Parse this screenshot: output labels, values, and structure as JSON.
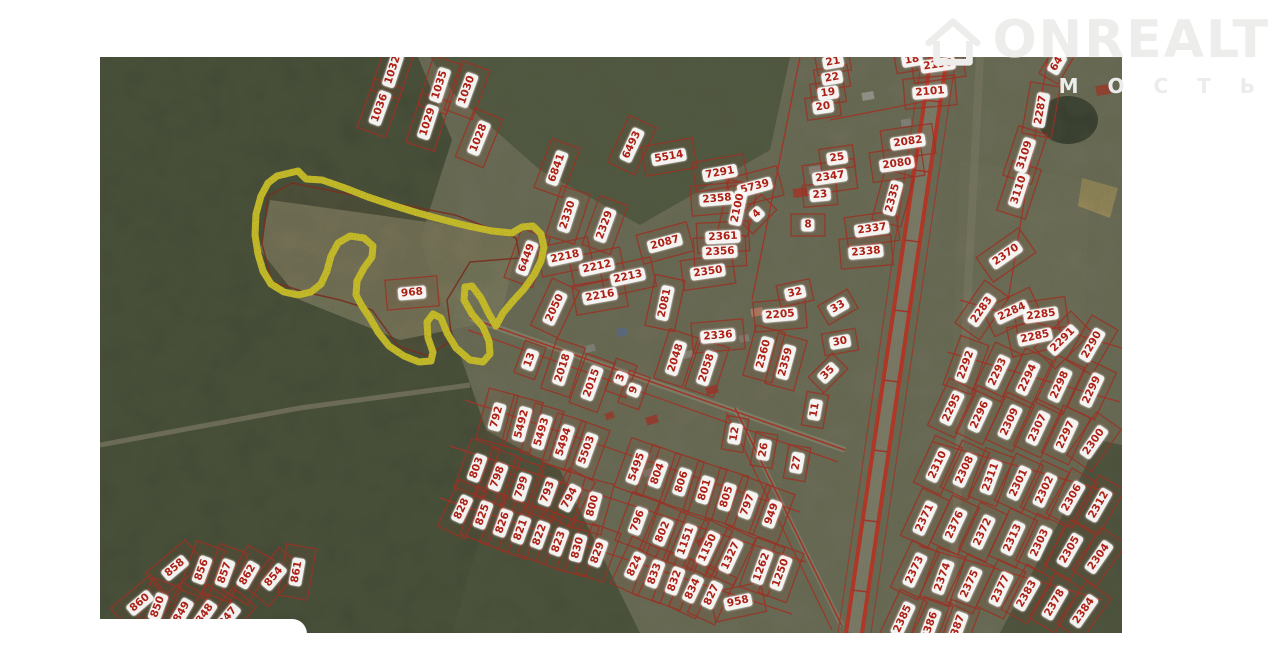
{
  "watermark": {
    "brand": "ONREALT",
    "subtext": "М О С Т Ь"
  },
  "map": {
    "type": "satellite-cadastral",
    "highlight": {
      "area_label": "968",
      "parcel_id": "6449",
      "outline_color": "#f4e41c",
      "boundary_color": "#8a1f10"
    },
    "label_color": "#ad2015",
    "parcel_line_color": "#c0281c",
    "parcels": [
      {
        "t": "1032",
        "x": 393,
        "y": 70,
        "a": -72
      },
      {
        "t": "1036",
        "x": 380,
        "y": 108,
        "a": -70
      },
      {
        "t": "1035",
        "x": 440,
        "y": 85,
        "a": -72
      },
      {
        "t": "1030",
        "x": 467,
        "y": 90,
        "a": -70
      },
      {
        "t": "1029",
        "x": 428,
        "y": 122,
        "a": -72
      },
      {
        "t": "1028",
        "x": 479,
        "y": 138,
        "a": -68
      },
      {
        "t": "6841",
        "x": 557,
        "y": 168,
        "a": -70
      },
      {
        "t": "6493",
        "x": 632,
        "y": 145,
        "a": -65
      },
      {
        "t": "5514",
        "x": 669,
        "y": 157,
        "a": -10
      },
      {
        "t": "2330",
        "x": 568,
        "y": 215,
        "a": -72
      },
      {
        "t": "2329",
        "x": 605,
        "y": 225,
        "a": -70
      },
      {
        "t": "7291",
        "x": 720,
        "y": 173,
        "a": -10
      },
      {
        "t": "5739",
        "x": 755,
        "y": 187,
        "a": -15
      },
      {
        "t": "2358",
        "x": 717,
        "y": 199,
        "a": -5
      },
      {
        "t": "2100",
        "x": 738,
        "y": 208,
        "a": -78
      },
      {
        "t": "4",
        "x": 757,
        "y": 214,
        "a": -45
      },
      {
        "t": "2361",
        "x": 723,
        "y": 237,
        "a": -3
      },
      {
        "t": "2356",
        "x": 720,
        "y": 252,
        "a": -3
      },
      {
        "t": "2350",
        "x": 708,
        "y": 272,
        "a": -8
      },
      {
        "t": "2087",
        "x": 665,
        "y": 243,
        "a": -15
      },
      {
        "t": "2081",
        "x": 665,
        "y": 303,
        "a": -78
      },
      {
        "t": "6449",
        "x": 527,
        "y": 258,
        "a": -70
      },
      {
        "t": "968",
        "x": 412,
        "y": 293,
        "a": -5
      },
      {
        "t": "2218",
        "x": 565,
        "y": 257,
        "a": -12
      },
      {
        "t": "2212",
        "x": 597,
        "y": 267,
        "a": -12
      },
      {
        "t": "2213",
        "x": 628,
        "y": 277,
        "a": -12
      },
      {
        "t": "2216",
        "x": 600,
        "y": 296,
        "a": -10
      },
      {
        "t": "2050",
        "x": 555,
        "y": 308,
        "a": -65
      },
      {
        "t": "21",
        "x": 833,
        "y": 62,
        "a": -10
      },
      {
        "t": "22",
        "x": 832,
        "y": 78,
        "a": -10
      },
      {
        "t": "19",
        "x": 828,
        "y": 93,
        "a": -8
      },
      {
        "t": "20",
        "x": 823,
        "y": 107,
        "a": -8
      },
      {
        "t": "18",
        "x": 912,
        "y": 60,
        "a": -10
      },
      {
        "t": "2196",
        "x": 938,
        "y": 65,
        "a": -8
      },
      {
        "t": "2101",
        "x": 930,
        "y": 92,
        "a": -5
      },
      {
        "t": "2082",
        "x": 908,
        "y": 142,
        "a": -8
      },
      {
        "t": "2080",
        "x": 897,
        "y": 164,
        "a": -8
      },
      {
        "t": "25",
        "x": 837,
        "y": 158,
        "a": -8
      },
      {
        "t": "2347",
        "x": 830,
        "y": 177,
        "a": -8
      },
      {
        "t": "23",
        "x": 820,
        "y": 195,
        "a": -5
      },
      {
        "t": "8",
        "x": 808,
        "y": 225,
        "a": 0
      },
      {
        "t": "2335",
        "x": 893,
        "y": 198,
        "a": -75
      },
      {
        "t": "2337",
        "x": 872,
        "y": 229,
        "a": -8
      },
      {
        "t": "2338",
        "x": 866,
        "y": 252,
        "a": -5
      },
      {
        "t": "64",
        "x": 1057,
        "y": 64,
        "a": -60
      },
      {
        "t": "2287",
        "x": 1041,
        "y": 110,
        "a": -80
      },
      {
        "t": "3109",
        "x": 1025,
        "y": 155,
        "a": -72
      },
      {
        "t": "3110",
        "x": 1019,
        "y": 190,
        "a": -72
      },
      {
        "t": "2370",
        "x": 1006,
        "y": 255,
        "a": -35
      },
      {
        "t": "2336",
        "x": 718,
        "y": 336,
        "a": -5
      },
      {
        "t": "32",
        "x": 795,
        "y": 293,
        "a": -12
      },
      {
        "t": "33",
        "x": 838,
        "y": 307,
        "a": -30
      },
      {
        "t": "2205",
        "x": 780,
        "y": 315,
        "a": -5
      },
      {
        "t": "30",
        "x": 840,
        "y": 342,
        "a": -10
      },
      {
        "t": "2360",
        "x": 764,
        "y": 354,
        "a": -75
      },
      {
        "t": "2359",
        "x": 786,
        "y": 362,
        "a": -75
      },
      {
        "t": "35",
        "x": 828,
        "y": 373,
        "a": -45
      },
      {
        "t": "11",
        "x": 815,
        "y": 410,
        "a": -80
      },
      {
        "t": "12",
        "x": 735,
        "y": 434,
        "a": -80
      },
      {
        "t": "26",
        "x": 764,
        "y": 450,
        "a": -80
      },
      {
        "t": "27",
        "x": 797,
        "y": 463,
        "a": -80
      },
      {
        "t": "2048",
        "x": 676,
        "y": 358,
        "a": -72
      },
      {
        "t": "2058",
        "x": 707,
        "y": 368,
        "a": -72
      },
      {
        "t": "13",
        "x": 530,
        "y": 360,
        "a": -70
      },
      {
        "t": "2018",
        "x": 563,
        "y": 368,
        "a": -72
      },
      {
        "t": "2015",
        "x": 592,
        "y": 383,
        "a": -70
      },
      {
        "t": "3",
        "x": 621,
        "y": 378,
        "a": -70
      },
      {
        "t": "9",
        "x": 634,
        "y": 390,
        "a": -70
      },
      {
        "t": "792",
        "x": 497,
        "y": 417,
        "a": -75
      },
      {
        "t": "5492",
        "x": 522,
        "y": 424,
        "a": -75
      },
      {
        "t": "5493",
        "x": 542,
        "y": 432,
        "a": -73
      },
      {
        "t": "5494",
        "x": 564,
        "y": 442,
        "a": -72
      },
      {
        "t": "5503",
        "x": 587,
        "y": 450,
        "a": -70
      },
      {
        "t": "5495",
        "x": 637,
        "y": 467,
        "a": -70
      },
      {
        "t": "804",
        "x": 658,
        "y": 474,
        "a": -70
      },
      {
        "t": "806",
        "x": 682,
        "y": 482,
        "a": -72
      },
      {
        "t": "801",
        "x": 705,
        "y": 490,
        "a": -73
      },
      {
        "t": "805",
        "x": 727,
        "y": 497,
        "a": -73
      },
      {
        "t": "797",
        "x": 748,
        "y": 505,
        "a": -70
      },
      {
        "t": "949",
        "x": 772,
        "y": 514,
        "a": -70
      },
      {
        "t": "803",
        "x": 477,
        "y": 468,
        "a": -70
      },
      {
        "t": "798",
        "x": 498,
        "y": 477,
        "a": -70
      },
      {
        "t": "799",
        "x": 522,
        "y": 487,
        "a": -72
      },
      {
        "t": "793",
        "x": 548,
        "y": 492,
        "a": -70
      },
      {
        "t": "794",
        "x": 570,
        "y": 498,
        "a": -62
      },
      {
        "t": "800",
        "x": 593,
        "y": 506,
        "a": -75
      },
      {
        "t": "796",
        "x": 638,
        "y": 521,
        "a": -70
      },
      {
        "t": "802",
        "x": 663,
        "y": 532,
        "a": -67
      },
      {
        "t": "1151",
        "x": 686,
        "y": 541,
        "a": -70
      },
      {
        "t": "1150",
        "x": 708,
        "y": 548,
        "a": -65
      },
      {
        "t": "1327",
        "x": 731,
        "y": 556,
        "a": -65
      },
      {
        "t": "1262",
        "x": 762,
        "y": 567,
        "a": -70
      },
      {
        "t": "1250",
        "x": 781,
        "y": 573,
        "a": -70
      },
      {
        "t": "828",
        "x": 462,
        "y": 509,
        "a": -65
      },
      {
        "t": "825",
        "x": 483,
        "y": 515,
        "a": -70
      },
      {
        "t": "826",
        "x": 503,
        "y": 523,
        "a": -70
      },
      {
        "t": "821",
        "x": 521,
        "y": 530,
        "a": -70
      },
      {
        "t": "822",
        "x": 540,
        "y": 535,
        "a": -70
      },
      {
        "t": "823",
        "x": 559,
        "y": 542,
        "a": -70
      },
      {
        "t": "830",
        "x": 578,
        "y": 548,
        "a": -75
      },
      {
        "t": "829",
        "x": 598,
        "y": 553,
        "a": -70
      },
      {
        "t": "824",
        "x": 635,
        "y": 566,
        "a": -65
      },
      {
        "t": "833",
        "x": 655,
        "y": 574,
        "a": -70
      },
      {
        "t": "832",
        "x": 675,
        "y": 581,
        "a": -70
      },
      {
        "t": "834",
        "x": 693,
        "y": 589,
        "a": -65
      },
      {
        "t": "827",
        "x": 712,
        "y": 595,
        "a": -65
      },
      {
        "t": "958",
        "x": 738,
        "y": 602,
        "a": -12
      },
      {
        "t": "2283",
        "x": 982,
        "y": 310,
        "a": -55
      },
      {
        "t": "2284",
        "x": 1012,
        "y": 312,
        "a": -25
      },
      {
        "t": "2285",
        "x": 1041,
        "y": 315,
        "a": -8
      },
      {
        "t": "2285",
        "x": 1035,
        "y": 337,
        "a": -12
      },
      {
        "t": "2291",
        "x": 1063,
        "y": 340,
        "a": -45
      },
      {
        "t": "2290",
        "x": 1092,
        "y": 345,
        "a": -60
      },
      {
        "t": "2292",
        "x": 966,
        "y": 365,
        "a": -70
      },
      {
        "t": "2293",
        "x": 998,
        "y": 372,
        "a": -65
      },
      {
        "t": "2294",
        "x": 1028,
        "y": 378,
        "a": -65
      },
      {
        "t": "2298",
        "x": 1060,
        "y": 385,
        "a": -65
      },
      {
        "t": "2299",
        "x": 1092,
        "y": 390,
        "a": -65
      },
      {
        "t": "2295",
        "x": 952,
        "y": 408,
        "a": -65
      },
      {
        "t": "2296",
        "x": 980,
        "y": 415,
        "a": -65
      },
      {
        "t": "2309",
        "x": 1010,
        "y": 422,
        "a": -65
      },
      {
        "t": "2307",
        "x": 1038,
        "y": 428,
        "a": -65
      },
      {
        "t": "2297",
        "x": 1066,
        "y": 435,
        "a": -65
      },
      {
        "t": "2300",
        "x": 1094,
        "y": 442,
        "a": -55
      },
      {
        "t": "2310",
        "x": 938,
        "y": 465,
        "a": -65
      },
      {
        "t": "2308",
        "x": 965,
        "y": 470,
        "a": -65
      },
      {
        "t": "2311",
        "x": 991,
        "y": 477,
        "a": -70
      },
      {
        "t": "2301",
        "x": 1019,
        "y": 483,
        "a": -65
      },
      {
        "t": "2302",
        "x": 1045,
        "y": 490,
        "a": -65
      },
      {
        "t": "2306",
        "x": 1072,
        "y": 498,
        "a": -60
      },
      {
        "t": "2312",
        "x": 1099,
        "y": 505,
        "a": -60
      },
      {
        "t": "2371",
        "x": 925,
        "y": 518,
        "a": -65
      },
      {
        "t": "2376",
        "x": 955,
        "y": 525,
        "a": -65
      },
      {
        "t": "2372",
        "x": 983,
        "y": 532,
        "a": -65
      },
      {
        "t": "2313",
        "x": 1013,
        "y": 538,
        "a": -65
      },
      {
        "t": "2303",
        "x": 1040,
        "y": 543,
        "a": -65
      },
      {
        "t": "2305",
        "x": 1070,
        "y": 550,
        "a": -60
      },
      {
        "t": "2304",
        "x": 1099,
        "y": 557,
        "a": -55
      },
      {
        "t": "2373",
        "x": 915,
        "y": 570,
        "a": -65
      },
      {
        "t": "2374",
        "x": 943,
        "y": 577,
        "a": -70
      },
      {
        "t": "2375",
        "x": 970,
        "y": 584,
        "a": -65
      },
      {
        "t": "2377",
        "x": 1001,
        "y": 589,
        "a": -65
      },
      {
        "t": "2383",
        "x": 1027,
        "y": 594,
        "a": -60
      },
      {
        "t": "2378",
        "x": 1055,
        "y": 603,
        "a": -60
      },
      {
        "t": "2384",
        "x": 1084,
        "y": 611,
        "a": -55
      },
      {
        "t": "2385",
        "x": 903,
        "y": 619,
        "a": -65
      },
      {
        "t": "2386",
        "x": 930,
        "y": 626,
        "a": -70
      },
      {
        "t": "2387",
        "x": 957,
        "y": 629,
        "a": -70
      },
      {
        "t": "858",
        "x": 175,
        "y": 568,
        "a": -40
      },
      {
        "t": "856",
        "x": 202,
        "y": 570,
        "a": -70
      },
      {
        "t": "857",
        "x": 225,
        "y": 573,
        "a": -70
      },
      {
        "t": "862",
        "x": 248,
        "y": 575,
        "a": -60
      },
      {
        "t": "854",
        "x": 274,
        "y": 577,
        "a": -50
      },
      {
        "t": "861",
        "x": 297,
        "y": 572,
        "a": -80
      },
      {
        "t": "860",
        "x": 140,
        "y": 603,
        "a": -40
      },
      {
        "t": "850",
        "x": 158,
        "y": 607,
        "a": -70
      },
      {
        "t": "849",
        "x": 182,
        "y": 612,
        "a": -60
      },
      {
        "t": "848",
        "x": 205,
        "y": 614,
        "a": -55
      },
      {
        "t": "847",
        "x": 228,
        "y": 617,
        "a": -50
      }
    ]
  }
}
